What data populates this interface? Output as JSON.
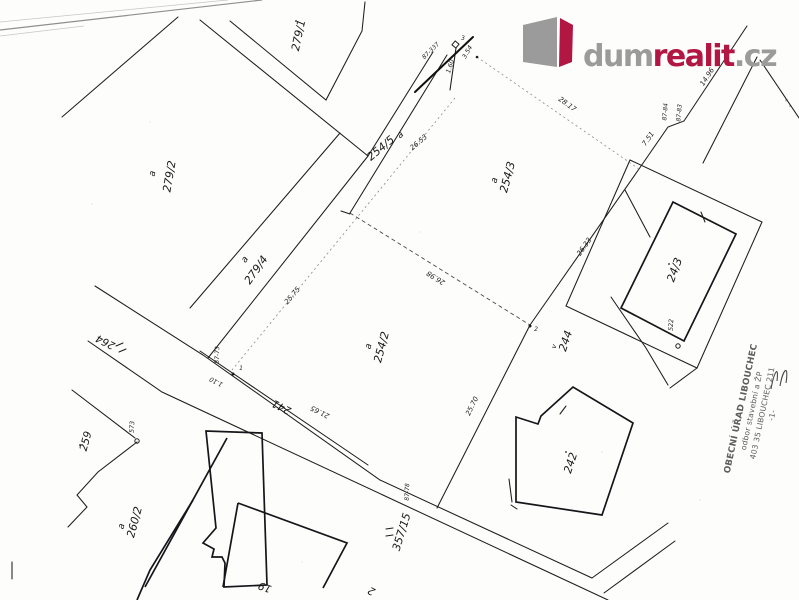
{
  "colors": {
    "brand_red": "#b11742",
    "brand_gray": "#9b9b9b",
    "line_black": "#1d1d1b",
    "stamp_gray": "#5d5d5d"
  },
  "logo": {
    "dum": "dum",
    "realit": "realit",
    "cz": ".cz"
  },
  "stamp": {
    "line1": "OBECNÍ ÚŘAD LIBOUCHEC",
    "line2": "odbor stavební a ŽP",
    "line3": "403 35 LIBOUCHEC 211",
    "line4": "-1-"
  },
  "map": {
    "parcels": {
      "p279_1": "279/1",
      "p279_2": "279/2",
      "p279_4": "279/4",
      "p254_5": "254/5",
      "p254_3": "254/3",
      "p254_2": "254/2",
      "p264": "264",
      "p259": "259",
      "p260_2": "260/2",
      "p241": "241",
      "p357_15": "357/15",
      "p244": "244",
      "b242": "242",
      "b24_3": "24/3",
      "b19": "19",
      "b2": "2",
      "pt573": "573",
      "pt522": "522"
    },
    "marker_a": "a",
    "marker_v": "v",
    "measurements": {
      "m2653": "26.53",
      "m2817": "28.17",
      "m2575": "25.75",
      "m2698": "26.98",
      "m2633": "26.33",
      "m751": "7.51",
      "m1496": "14.96",
      "m2570": "25.70",
      "m2165": "21.65",
      "m160": "1.60",
      "m354": "3.54",
      "m110": "1.10"
    },
    "survey_points": {
      "s87_337": "87-337",
      "s87_73": "87-73",
      "s87_78": "87-78",
      "s87_84": "87-84",
      "s87_83": "87-83"
    },
    "point_nums": {
      "n1": "1",
      "n2": "2",
      "n3": "3"
    }
  }
}
